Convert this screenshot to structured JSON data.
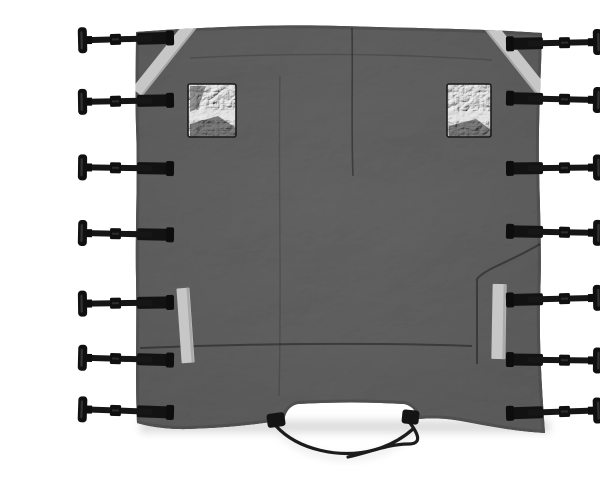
{
  "scene": {
    "subject": "Product photo of a black canvas cover tarp with side-release T-toggle buckle straps on a white background",
    "tarp": {
      "shape": "large square tarp with wavy fabric edges and a rounded notch cutout at bottom center",
      "texture": "wrinkled matte black canvas"
    },
    "straps": {
      "left_count": 7,
      "right_count": 7,
      "style": "black webbing with slider buckle and T-toggle end",
      "left_y": [
        23,
        85,
        152,
        218,
        287,
        343,
        395
      ],
      "right_y": [
        27,
        83,
        152,
        216,
        283,
        344,
        396
      ],
      "left_tilt": [
        -1.5,
        -1,
        0.8,
        1.2,
        -0.8,
        1.5,
        2
      ],
      "right_tilt": [
        1.2,
        -1.2,
        0.6,
        -1,
        1.4,
        -0.6,
        1.8
      ]
    },
    "reflective_strips": {
      "count": 4,
      "placements": [
        "top-left diagonal",
        "top-right diagonal",
        "lower-left vertical",
        "lower-right vertical"
      ]
    },
    "windows": {
      "count": 2,
      "material": "crinkled clear vinyl",
      "placement": "upper left and upper right of tarp"
    },
    "bottom": {
      "notch": "rounded cutout at bottom center with two small fabric tabs",
      "tie_cords": 2
    }
  },
  "theme": {
    "background": "#ffffff",
    "fabric": "#242424",
    "fabric_light": "#313131",
    "fabric_edge": "#141414",
    "strap": "#161616",
    "reflective": "#c7c7c7",
    "window": "#9a9a9a",
    "cord": "#1c1c1c",
    "shadow": "#dedede"
  }
}
